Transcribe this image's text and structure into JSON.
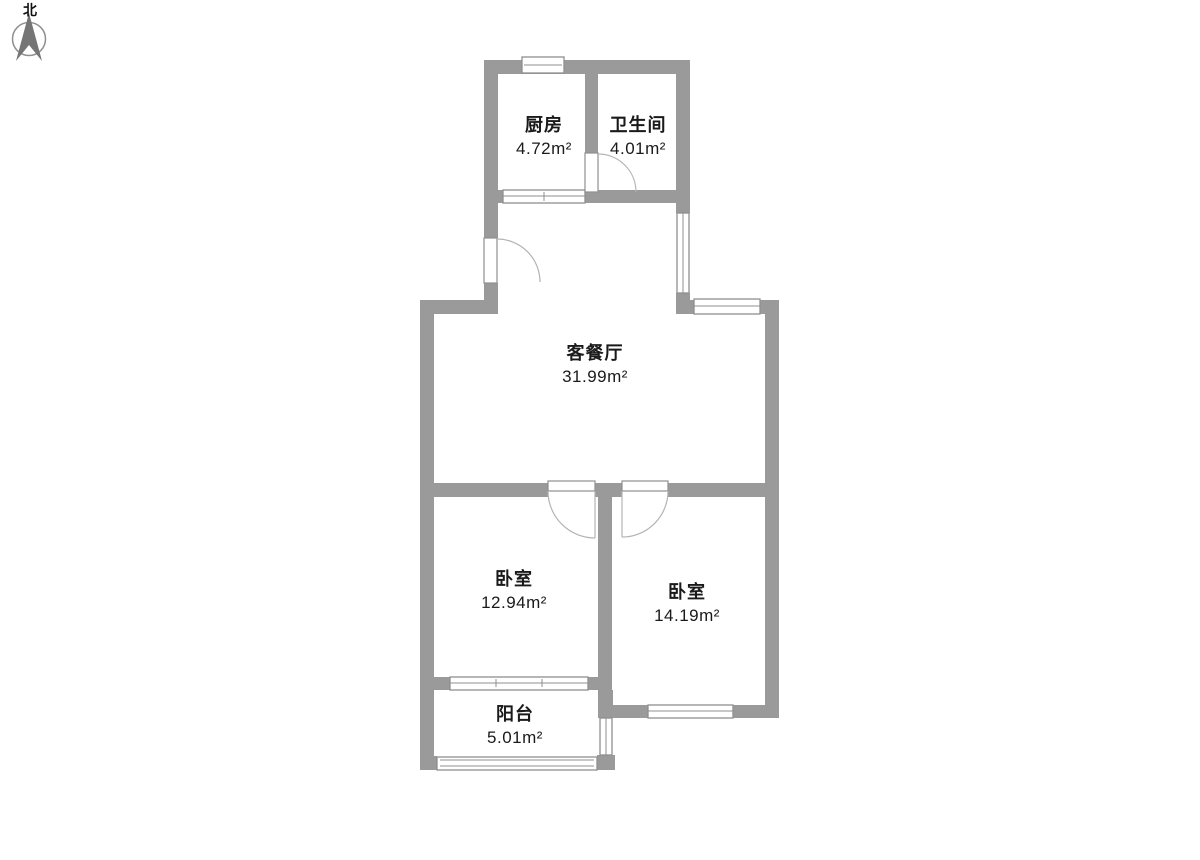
{
  "compass": {
    "label": "北"
  },
  "colors": {
    "wall": "#9a9a9a",
    "text": "#1a1a1a",
    "door_arc": "#b3b3b3",
    "window": "#8f8f8f",
    "compass_arrow": "#757575"
  },
  "rooms": [
    {
      "id": "kitchen",
      "name": "厨房",
      "area": "4.72m²"
    },
    {
      "id": "bathroom",
      "name": "卫生间",
      "area": "4.01m²"
    },
    {
      "id": "living-dining",
      "name": "客餐厅",
      "area": "31.99m²"
    },
    {
      "id": "bedroom-left",
      "name": "卧室",
      "area": "12.94m²"
    },
    {
      "id": "bedroom-right",
      "name": "卧室",
      "area": "14.19m²"
    },
    {
      "id": "balcony",
      "name": "阳台",
      "area": "5.01m²"
    }
  ]
}
